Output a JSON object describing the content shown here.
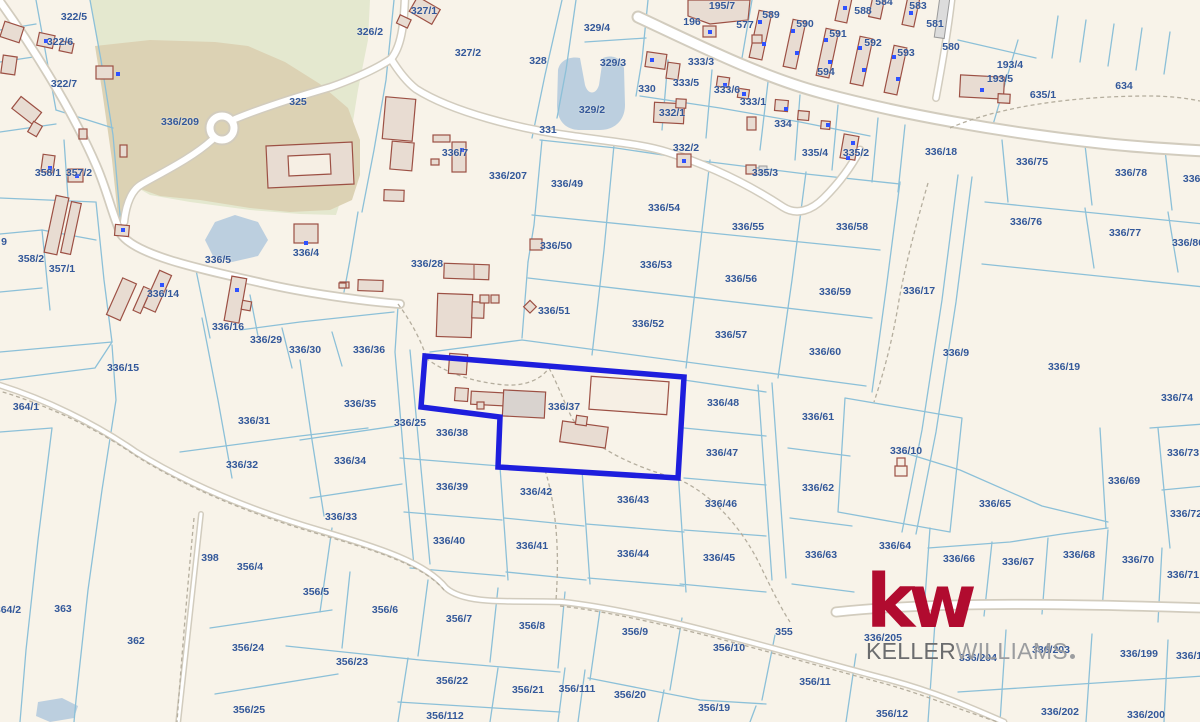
{
  "map": {
    "highlighted_parcel": "336/37",
    "parcel_labels": [
      {
        "t": "322/5",
        "x": 74,
        "y": 17
      },
      {
        "t": "322/6",
        "x": 60,
        "y": 42
      },
      {
        "t": "322/7",
        "x": 64,
        "y": 84
      },
      {
        "t": "336/209",
        "x": 180,
        "y": 122
      },
      {
        "t": "325",
        "x": 298,
        "y": 102
      },
      {
        "t": "326/2",
        "x": 370,
        "y": 32
      },
      {
        "t": "327/1",
        "x": 424,
        "y": 11
      },
      {
        "t": "327/2",
        "x": 468,
        "y": 53
      },
      {
        "t": "328",
        "x": 538,
        "y": 61
      },
      {
        "t": "329/4",
        "x": 597,
        "y": 28
      },
      {
        "t": "329/3",
        "x": 613,
        "y": 63
      },
      {
        "t": "329/2",
        "x": 592,
        "y": 110
      },
      {
        "t": "331",
        "x": 548,
        "y": 130
      },
      {
        "t": "330",
        "x": 647,
        "y": 89
      },
      {
        "t": "333/3",
        "x": 701,
        "y": 62
      },
      {
        "t": "333/5",
        "x": 686,
        "y": 83
      },
      {
        "t": "333/6",
        "x": 727,
        "y": 90
      },
      {
        "t": "333/1",
        "x": 753,
        "y": 102
      },
      {
        "t": "332/1",
        "x": 672,
        "y": 113
      },
      {
        "t": "332/2",
        "x": 686,
        "y": 148
      },
      {
        "t": "334",
        "x": 783,
        "y": 124
      },
      {
        "t": "335/4",
        "x": 815,
        "y": 153
      },
      {
        "t": "335/2",
        "x": 856,
        "y": 153
      },
      {
        "t": "335/3",
        "x": 765,
        "y": 173
      },
      {
        "t": "195/7",
        "x": 722,
        "y": 6
      },
      {
        "t": "196",
        "x": 692,
        "y": 22
      },
      {
        "t": "577",
        "x": 745,
        "y": 25
      },
      {
        "t": "589",
        "x": 771,
        "y": 15
      },
      {
        "t": "590",
        "x": 805,
        "y": 24
      },
      {
        "t": "591",
        "x": 838,
        "y": 34
      },
      {
        "t": "592",
        "x": 873,
        "y": 43
      },
      {
        "t": "593",
        "x": 906,
        "y": 53
      },
      {
        "t": "588",
        "x": 863,
        "y": 11
      },
      {
        "t": "584",
        "x": 884,
        "y": 2
      },
      {
        "t": "583",
        "x": 918,
        "y": 6
      },
      {
        "t": "581",
        "x": 935,
        "y": 24
      },
      {
        "t": "580",
        "x": 951,
        "y": 47
      },
      {
        "t": "594",
        "x": 826,
        "y": 72
      },
      {
        "t": "193/4",
        "x": 1010,
        "y": 65
      },
      {
        "t": "193/5",
        "x": 1000,
        "y": 79
      },
      {
        "t": "635/1",
        "x": 1043,
        "y": 95
      },
      {
        "t": "634",
        "x": 1124,
        "y": 86
      },
      {
        "t": "336/18",
        "x": 941,
        "y": 152
      },
      {
        "t": "336/75",
        "x": 1032,
        "y": 162
      },
      {
        "t": "336/78",
        "x": 1131,
        "y": 173
      },
      {
        "t": "336/7",
        "x": 1196,
        "y": 179
      },
      {
        "t": "336/76",
        "x": 1026,
        "y": 222
      },
      {
        "t": "336/77",
        "x": 1125,
        "y": 233
      },
      {
        "t": "336/80",
        "x": 1188,
        "y": 243
      },
      {
        "t": "358/1",
        "x": 48,
        "y": 173
      },
      {
        "t": "357/2",
        "x": 79,
        "y": 173
      },
      {
        "t": "358/2",
        "x": 31,
        "y": 259
      },
      {
        "t": "357/1",
        "x": 62,
        "y": 269
      },
      {
        "t": "9",
        "x": 4,
        "y": 242
      },
      {
        "t": "336/5",
        "x": 218,
        "y": 260
      },
      {
        "t": "336/4",
        "x": 306,
        "y": 253
      },
      {
        "t": "336/7",
        "x": 455,
        "y": 153
      },
      {
        "t": "336/14",
        "x": 163,
        "y": 294
      },
      {
        "t": "336/16",
        "x": 228,
        "y": 327
      },
      {
        "t": "336/29",
        "x": 266,
        "y": 340
      },
      {
        "t": "336/30",
        "x": 305,
        "y": 350
      },
      {
        "t": "336/36",
        "x": 369,
        "y": 350
      },
      {
        "t": "336/28",
        "x": 427,
        "y": 264
      },
      {
        "t": "336/207",
        "x": 508,
        "y": 176
      },
      {
        "t": "336/49",
        "x": 567,
        "y": 184
      },
      {
        "t": "336/50",
        "x": 556,
        "y": 246
      },
      {
        "t": "336/51",
        "x": 554,
        "y": 311
      },
      {
        "t": "336/54",
        "x": 664,
        "y": 208
      },
      {
        "t": "336/55",
        "x": 748,
        "y": 227
      },
      {
        "t": "336/58",
        "x": 852,
        "y": 227
      },
      {
        "t": "336/53",
        "x": 656,
        "y": 265
      },
      {
        "t": "336/56",
        "x": 741,
        "y": 279
      },
      {
        "t": "336/59",
        "x": 835,
        "y": 292
      },
      {
        "t": "336/52",
        "x": 648,
        "y": 324
      },
      {
        "t": "336/57",
        "x": 731,
        "y": 335
      },
      {
        "t": "336/60",
        "x": 825,
        "y": 352
      },
      {
        "t": "336/17",
        "x": 919,
        "y": 291
      },
      {
        "t": "336/9",
        "x": 956,
        "y": 353
      },
      {
        "t": "336/19",
        "x": 1064,
        "y": 367
      },
      {
        "t": "336/15",
        "x": 123,
        "y": 368
      },
      {
        "t": "364/1",
        "x": 26,
        "y": 407
      },
      {
        "t": "336/31",
        "x": 254,
        "y": 421
      },
      {
        "t": "336/32",
        "x": 242,
        "y": 465
      },
      {
        "t": "336/35",
        "x": 360,
        "y": 404
      },
      {
        "t": "336/34",
        "x": 350,
        "y": 461
      },
      {
        "t": "336/33",
        "x": 341,
        "y": 517
      },
      {
        "t": "336/25",
        "x": 410,
        "y": 423
      },
      {
        "t": "336/37",
        "x": 564,
        "y": 407
      },
      {
        "t": "336/38",
        "x": 452,
        "y": 433
      },
      {
        "t": "336/39",
        "x": 452,
        "y": 487
      },
      {
        "t": "336/40",
        "x": 449,
        "y": 541
      },
      {
        "t": "336/42",
        "x": 536,
        "y": 492
      },
      {
        "t": "336/41",
        "x": 532,
        "y": 546
      },
      {
        "t": "336/43",
        "x": 633,
        "y": 500
      },
      {
        "t": "336/44",
        "x": 633,
        "y": 554
      },
      {
        "t": "336/46",
        "x": 721,
        "y": 504
      },
      {
        "t": "336/45",
        "x": 719,
        "y": 558
      },
      {
        "t": "336/48",
        "x": 723,
        "y": 403
      },
      {
        "t": "336/47",
        "x": 722,
        "y": 453
      },
      {
        "t": "336/61",
        "x": 818,
        "y": 417
      },
      {
        "t": "336/62",
        "x": 818,
        "y": 488
      },
      {
        "t": "336/63",
        "x": 821,
        "y": 555
      },
      {
        "t": "336/10",
        "x": 906,
        "y": 451
      },
      {
        "t": "336/64",
        "x": 895,
        "y": 546
      },
      {
        "t": "336/65",
        "x": 995,
        "y": 504
      },
      {
        "t": "336/69",
        "x": 1124,
        "y": 481
      },
      {
        "t": "336/73",
        "x": 1183,
        "y": 453
      },
      {
        "t": "336/74",
        "x": 1177,
        "y": 398
      },
      {
        "t": "336/72",
        "x": 1186,
        "y": 514
      },
      {
        "t": "336/66",
        "x": 959,
        "y": 559
      },
      {
        "t": "336/67",
        "x": 1018,
        "y": 562
      },
      {
        "t": "336/68",
        "x": 1079,
        "y": 555
      },
      {
        "t": "336/70",
        "x": 1138,
        "y": 560
      },
      {
        "t": "336/71",
        "x": 1183,
        "y": 575
      },
      {
        "t": "398",
        "x": 210,
        "y": 558
      },
      {
        "t": "356/4",
        "x": 250,
        "y": 567
      },
      {
        "t": "363",
        "x": 63,
        "y": 609
      },
      {
        "t": "362",
        "x": 136,
        "y": 641
      },
      {
        "t": "364/2",
        "x": 8,
        "y": 610
      },
      {
        "t": "356/5",
        "x": 316,
        "y": 592
      },
      {
        "t": "356/6",
        "x": 385,
        "y": 610
      },
      {
        "t": "356/7",
        "x": 459,
        "y": 619
      },
      {
        "t": "356/8",
        "x": 532,
        "y": 626
      },
      {
        "t": "356/23",
        "x": 352,
        "y": 662
      },
      {
        "t": "356/22",
        "x": 452,
        "y": 681
      },
      {
        "t": "356/21",
        "x": 528,
        "y": 690
      },
      {
        "t": "356/111",
        "x": 577,
        "y": 689
      },
      {
        "t": "356/112",
        "x": 445,
        "y": 716
      },
      {
        "t": "356/24",
        "x": 248,
        "y": 648
      },
      {
        "t": "356/25",
        "x": 249,
        "y": 710
      },
      {
        "t": "356/9",
        "x": 635,
        "y": 632
      },
      {
        "t": "356/10",
        "x": 729,
        "y": 648
      },
      {
        "t": "355",
        "x": 784,
        "y": 632
      },
      {
        "t": "356/20",
        "x": 630,
        "y": 695
      },
      {
        "t": "356/19",
        "x": 714,
        "y": 708
      },
      {
        "t": "356/11",
        "x": 815,
        "y": 682
      },
      {
        "t": "356/12",
        "x": 892,
        "y": 714
      },
      {
        "t": "336/205",
        "x": 883,
        "y": 638
      },
      {
        "t": "336/204",
        "x": 978,
        "y": 658
      },
      {
        "t": "336/203",
        "x": 1051,
        "y": 650
      },
      {
        "t": "336/199",
        "x": 1139,
        "y": 654
      },
      {
        "t": "336/19",
        "x": 1192,
        "y": 656
      },
      {
        "t": "336/202",
        "x": 1060,
        "y": 712
      },
      {
        "t": "336/200",
        "x": 1146,
        "y": 715
      }
    ]
  },
  "logo": {
    "monogram": "kw",
    "name_top": "KELLER",
    "name_bottom": "WILLIAMS"
  },
  "colors": {
    "bg-cream": "#f8f3e9",
    "park-green": "#e4e8cf",
    "park-tan": "#dcd2b4",
    "water-blue": "#bccfdf",
    "parcel-line": "#8cc0d8",
    "road-casing": "#d2ccbe",
    "dash-gray": "#b5ae9e",
    "building-fill": "#e8dcd2",
    "building-gray": "#d9d3cf",
    "building-stroke": "#9c5044",
    "dot-blue": "#2f52ff",
    "highlight-blue": "#1e1edd",
    "label-blue": "#33589a",
    "kw-red": "#b10b2f",
    "keller-gray": "#6b6c6e",
    "williams-gray": "#9b9da0"
  }
}
